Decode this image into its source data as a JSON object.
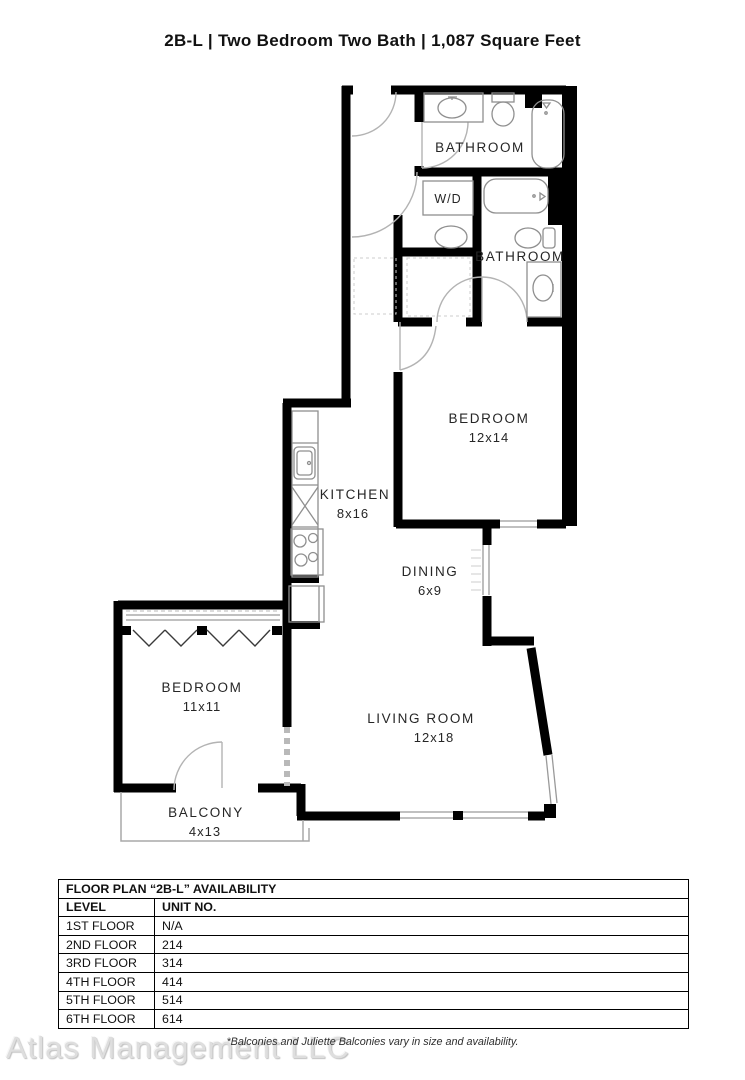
{
  "title": "2B-L | Two Bedroom Two Bath | 1,087  Square Feet",
  "rooms": {
    "bathroom_top": {
      "label": "BATHROOM"
    },
    "wd_closet": {
      "label": "W/D"
    },
    "bathroom_2": {
      "label": "BATHROOM"
    },
    "bedroom_main": {
      "label": "BEDROOM",
      "dims": "12x14"
    },
    "kitchen": {
      "label": "KITCHEN",
      "dims": "8x16"
    },
    "dining": {
      "label": "DINING",
      "dims": "6x9"
    },
    "bedroom_2": {
      "label": "BEDROOM",
      "dims": "11x11"
    },
    "living_room": {
      "label": "LIVING ROOM",
      "dims": "12x18"
    },
    "balcony": {
      "label": "BALCONY",
      "dims": "4x13"
    }
  },
  "fixtures": [
    "bathtub",
    "toilet",
    "sink",
    "vanity",
    "washer-dryer",
    "kitchen-sink",
    "dishwasher",
    "stove",
    "refrigerator",
    "closet-hatch",
    "door-swing",
    "window",
    "casement-chevron"
  ],
  "availability_table": {
    "title": "FLOOR PLAN “2B-L” AVAILABILITY",
    "columns": [
      "LEVEL",
      "UNIT NO."
    ],
    "rows": [
      [
        "1ST FLOOR",
        "N/A"
      ],
      [
        "2ND FLOOR",
        "214"
      ],
      [
        "3RD FLOOR",
        "314"
      ],
      [
        "4TH FLOOR",
        "414"
      ],
      [
        "5TH FLOOR",
        "514"
      ],
      [
        "6TH FLOOR",
        "614"
      ]
    ]
  },
  "footnote": "*Balconies and Juliette Balconies vary in size and availability.",
  "watermark": "Atlas Management LLC",
  "colors": {
    "wall": "#000000",
    "fixture_line": "#8f8f8f",
    "door_arc": "#b3b3b3",
    "text": "#262626",
    "watermark": "#dedede",
    "background": "#ffffff"
  }
}
